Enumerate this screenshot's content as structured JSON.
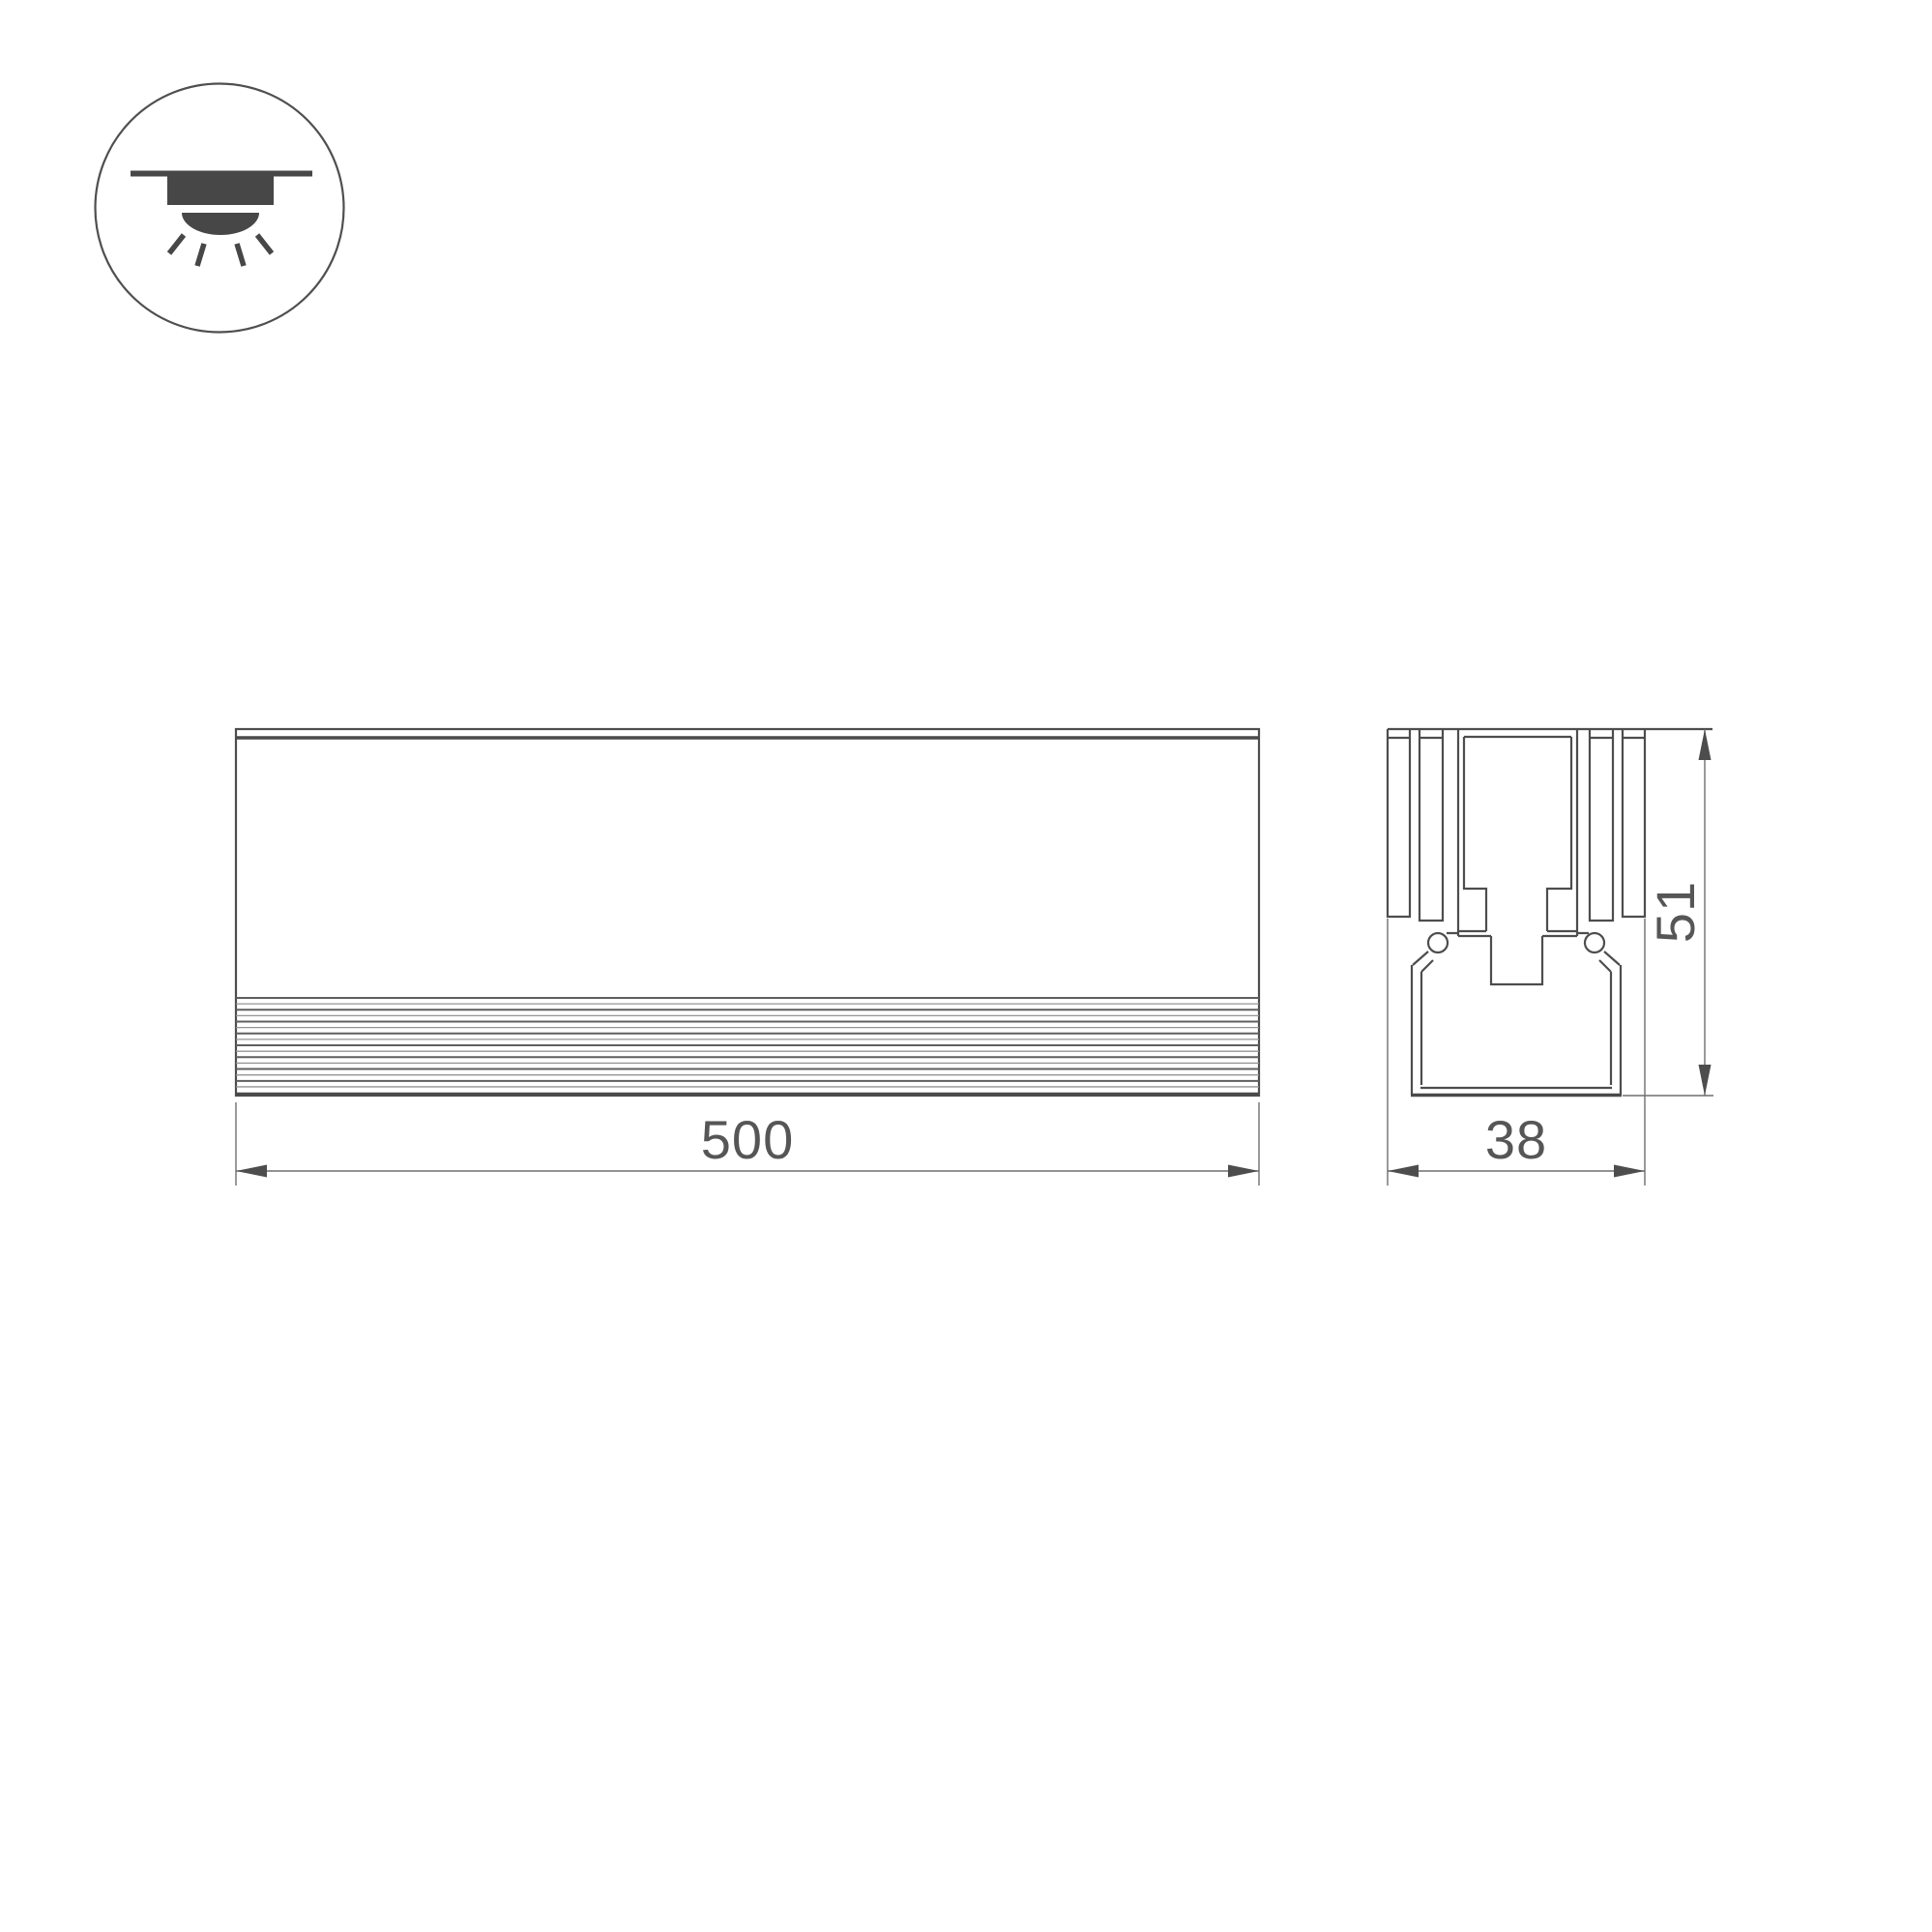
{
  "icon": {
    "name": "recessed-downlight-ceiling-icon"
  },
  "drawing": {
    "front_view": {
      "width_dim": {
        "label": "500"
      }
    },
    "section_view": {
      "width_dim": {
        "label": "38"
      },
      "height_dim": {
        "label": "51"
      }
    },
    "colors": {
      "line": "#4d4d4d",
      "dim_line": "#6e6e6e",
      "text": "#565656"
    }
  }
}
